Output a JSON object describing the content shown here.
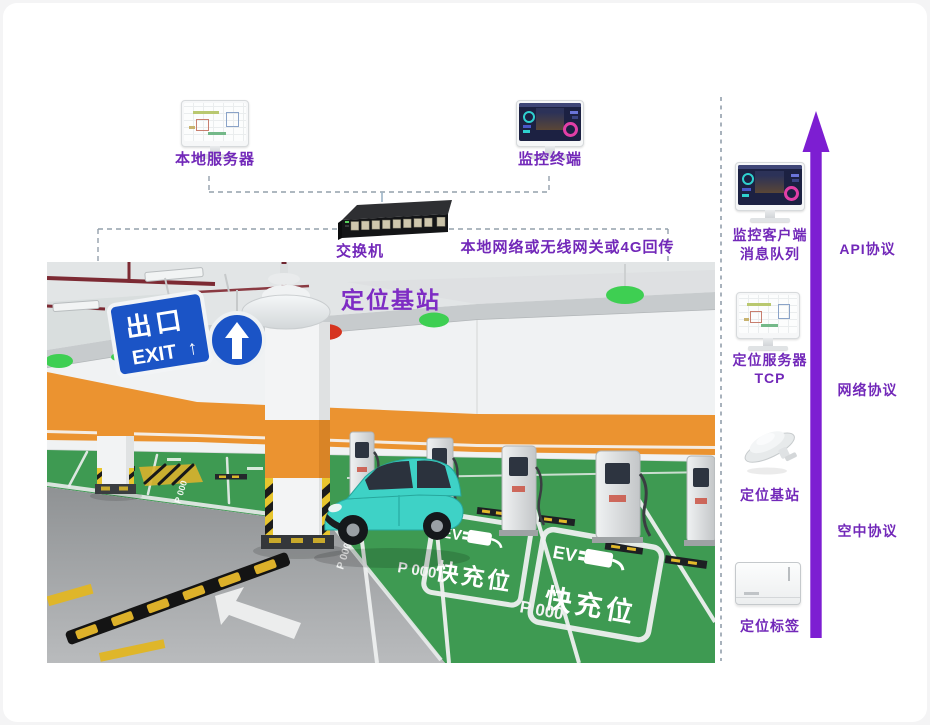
{
  "colors": {
    "label_purple": "#7228b9",
    "arrow_purple": "#7d1ed2",
    "dash_gray": "#94a0ac",
    "sign_blue": "#1b54c6",
    "floor_green": "#3e9a52",
    "band_orange": "#eb9330",
    "car_teal": "#3ed2c6"
  },
  "top": {
    "local_server_label": "本地服务器",
    "monitor_terminal_label": "监控终端",
    "switch_label": "交换机",
    "network_note": "本地网络或无线网关或4G回传"
  },
  "photo": {
    "base_station_label": "定位基站",
    "exit_line1": "出口",
    "exit_line2": "EXIT",
    "exit_arrow": "↑",
    "ev_text": "EV",
    "fast_charge_text": "快充位",
    "spot_number": "P 000"
  },
  "sidebar": {
    "item1_line1": "监控客户端",
    "item1_line2": "消息队列",
    "item2_line1": "定位服务器",
    "item2_line2": "TCP",
    "item3_label": "定位基站",
    "item4_label": "定位标签",
    "protocol_api": "API协议",
    "protocol_network": "网络协议",
    "protocol_air": "空中协议"
  }
}
